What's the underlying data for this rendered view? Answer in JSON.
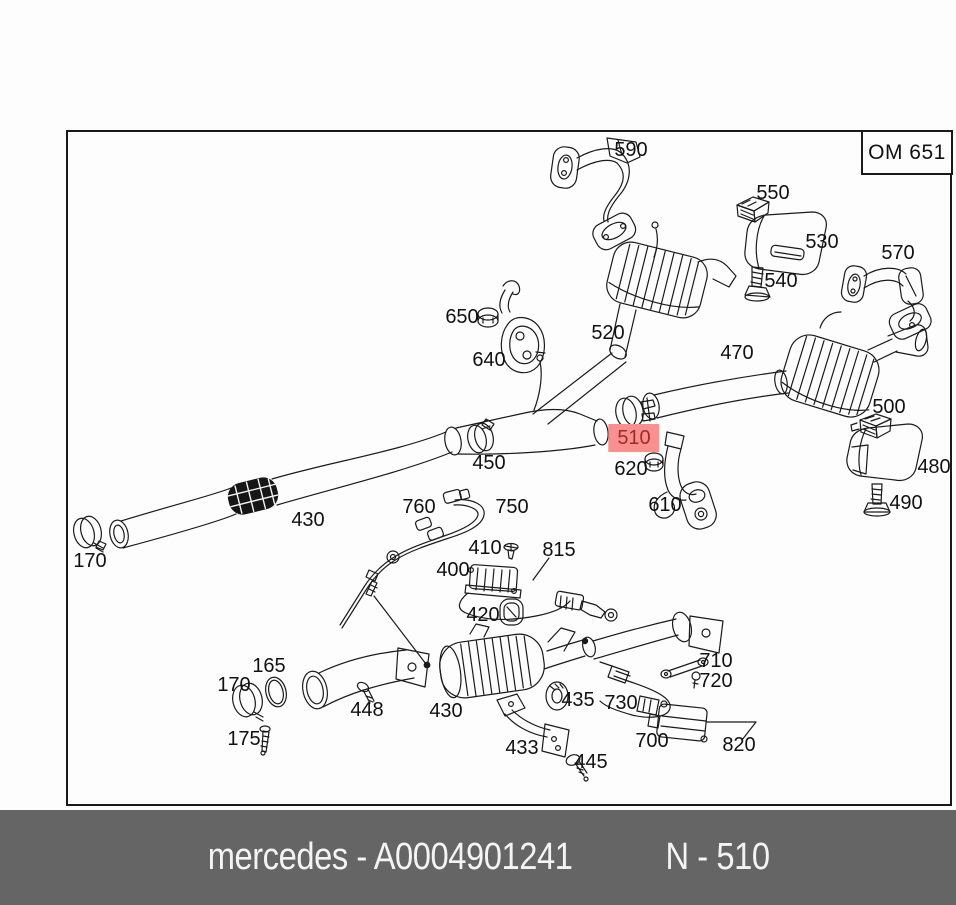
{
  "header": {
    "engine_code": "OM 651"
  },
  "caption": {
    "left_text": "mercedes - A0004901241",
    "right_text": "N - 510",
    "bg_color": "#656565",
    "text_color": "#f4f4f4"
  },
  "diagram": {
    "highlight_bg": "#F8908F",
    "highlight_text_color": "#A02B26",
    "line_color": "#1a1a1a",
    "highlighted_part": "510",
    "labels": [
      {
        "id": "590",
        "text": "590",
        "x": 631,
        "y": 150
      },
      {
        "id": "550",
        "text": "550",
        "x": 773,
        "y": 193
      },
      {
        "id": "530",
        "text": "530",
        "x": 822,
        "y": 242
      },
      {
        "id": "540",
        "text": "540",
        "x": 781,
        "y": 281
      },
      {
        "id": "570",
        "text": "570",
        "x": 898,
        "y": 253
      },
      {
        "id": "650",
        "text": "650",
        "x": 462,
        "y": 317
      },
      {
        "id": "640",
        "text": "640",
        "x": 489,
        "y": 360
      },
      {
        "id": "520",
        "text": "520",
        "x": 608,
        "y": 333
      },
      {
        "id": "470",
        "text": "470",
        "x": 737,
        "y": 353
      },
      {
        "id": "500",
        "text": "500",
        "x": 889,
        "y": 407
      },
      {
        "id": "480",
        "text": "480",
        "x": 934,
        "y": 467
      },
      {
        "id": "490",
        "text": "490",
        "x": 906,
        "y": 503
      },
      {
        "id": "450",
        "text": "450",
        "x": 489,
        "y": 463
      },
      {
        "id": "510",
        "text": "510",
        "x": 634,
        "y": 438,
        "highlighted": true
      },
      {
        "id": "620",
        "text": "620",
        "x": 631,
        "y": 469
      },
      {
        "id": "610",
        "text": "610",
        "x": 665,
        "y": 505
      },
      {
        "id": "430-front",
        "text": "430",
        "x": 308,
        "y": 520
      },
      {
        "id": "170-front",
        "text": "170",
        "x": 90,
        "y": 561
      },
      {
        "id": "760",
        "text": "760",
        "x": 419,
        "y": 507
      },
      {
        "id": "750",
        "text": "750",
        "x": 512,
        "y": 507
      },
      {
        "id": "410",
        "text": "410",
        "x": 485,
        "y": 548
      },
      {
        "id": "815",
        "text": "815",
        "x": 559,
        "y": 550
      },
      {
        "id": "400",
        "text": "400",
        "x": 453,
        "y": 570
      },
      {
        "id": "420",
        "text": "420",
        "x": 483,
        "y": 615
      },
      {
        "id": "165",
        "text": "165",
        "x": 269,
        "y": 666
      },
      {
        "id": "170-down",
        "text": "170",
        "x": 234,
        "y": 685
      },
      {
        "id": "448",
        "text": "448",
        "x": 367,
        "y": 710
      },
      {
        "id": "430-cat",
        "text": "430",
        "x": 446,
        "y": 711
      },
      {
        "id": "175",
        "text": "175",
        "x": 244,
        "y": 739
      },
      {
        "id": "433",
        "text": "433",
        "x": 522,
        "y": 748
      },
      {
        "id": "445",
        "text": "445",
        "x": 591,
        "y": 762
      },
      {
        "id": "435",
        "text": "435",
        "x": 578,
        "y": 700
      },
      {
        "id": "730",
        "text": "730",
        "x": 621,
        "y": 703
      },
      {
        "id": "700",
        "text": "700",
        "x": 652,
        "y": 741
      },
      {
        "id": "710",
        "text": "710",
        "x": 716,
        "y": 661
      },
      {
        "id": "720",
        "text": "720",
        "x": 716,
        "y": 681
      },
      {
        "id": "820",
        "text": "820",
        "x": 739,
        "y": 745
      }
    ]
  }
}
